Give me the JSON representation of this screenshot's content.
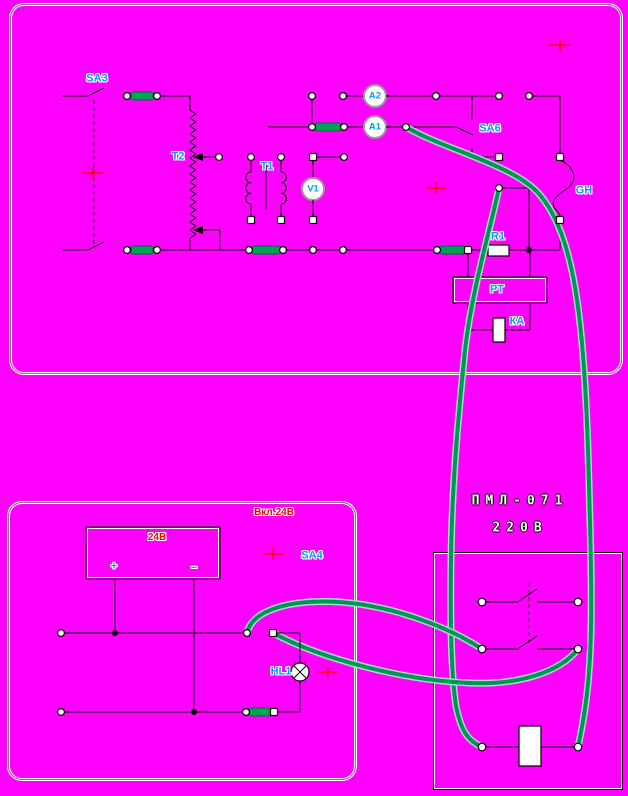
{
  "colors": {
    "background": "#FF00FF",
    "wire": "#000000",
    "patch_wire_green": "#009558",
    "fuse_green": "#00A055",
    "label_blue": "#0699FF",
    "label_red": "#FF0000",
    "panel_border_gray": "#7F7F7F",
    "panel_border_white": "#FFFFFF",
    "cursor_cross_red": "#FF0000"
  },
  "top_panel": {
    "labels": {
      "sa3": "SA3",
      "t2": "T2",
      "t1": "T1",
      "a2": "A2",
      "a1": "A1",
      "v1": "V1",
      "sa6": "SA6",
      "gh": "GH",
      "r1": "R1",
      "rt": "РТ",
      "ka": "КА"
    }
  },
  "bottom_left_panel": {
    "labels": {
      "title": "Вкл.24В",
      "source": "24В",
      "plus": "+",
      "minus": "–",
      "sa4": "SA4",
      "hl1": "HL1"
    }
  },
  "contactor_panel": {
    "line1": "ПМЛ-071",
    "line2": "220В"
  }
}
